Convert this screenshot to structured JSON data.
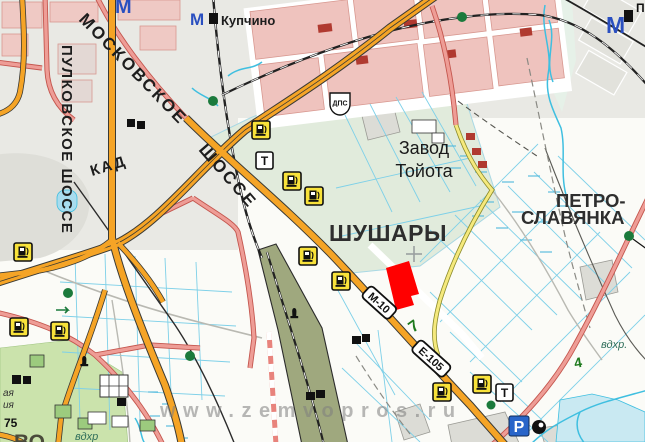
{
  "map": {
    "watermark": "www.zemvopros.ru",
    "place_labels": {
      "moskovskoe": "МОСКОВСКОЕ",
      "shosse": "ШОССЕ",
      "pulkovskoe": "ПУЛКОВСКОЕ ШОССЕ",
      "kad": "КАД",
      "kupchino": "Купчино",
      "zavod_line1": "Завод",
      "zavod_line2": "Тойота",
      "shushary": "ШУШАРЫ",
      "petro_line1": "ПЕТРО-",
      "petro_line2": "СЛАВЯНКА",
      "vo_partial": "ВО",
      "p_partial": "П"
    },
    "road_badges": {
      "m10": "М-10",
      "e105": "Е-105",
      "dps": "ДПС"
    },
    "small_labels": {
      "km7": "7",
      "tree4": "4",
      "n75": "75",
      "aya": "ая",
      "iya": "ия",
      "vdhr_right": "вдхр.",
      "vdhr_bottom": "вдхр"
    },
    "icon_glyphs": {
      "metro": "М",
      "parking": "Р",
      "service": "Т"
    },
    "icon_names": [
      "gas-station-icon",
      "car-service-icon",
      "parking-icon",
      "metro-icon",
      "traffic-post-icon",
      "monument-icon",
      "landmark-icon",
      "police-post-badge"
    ],
    "colors": {
      "highway_orange": "#F5A426",
      "road_pink": "#EE9D96",
      "road_yellow": "#F5E97D",
      "water_blue": "#3FBFE0",
      "ditch_blue": "#7ED0E8",
      "parcel_red": "#FF0000",
      "forest_green": "#CBE3AC",
      "field_green": "#E1EBDC",
      "metro_blue": "#2A4FC0",
      "parking_blue": "#2965C9",
      "gas_yellow": "#F8E23A",
      "km_green": "#1E7A1E",
      "rail_olive": "#9FA87E"
    }
  }
}
